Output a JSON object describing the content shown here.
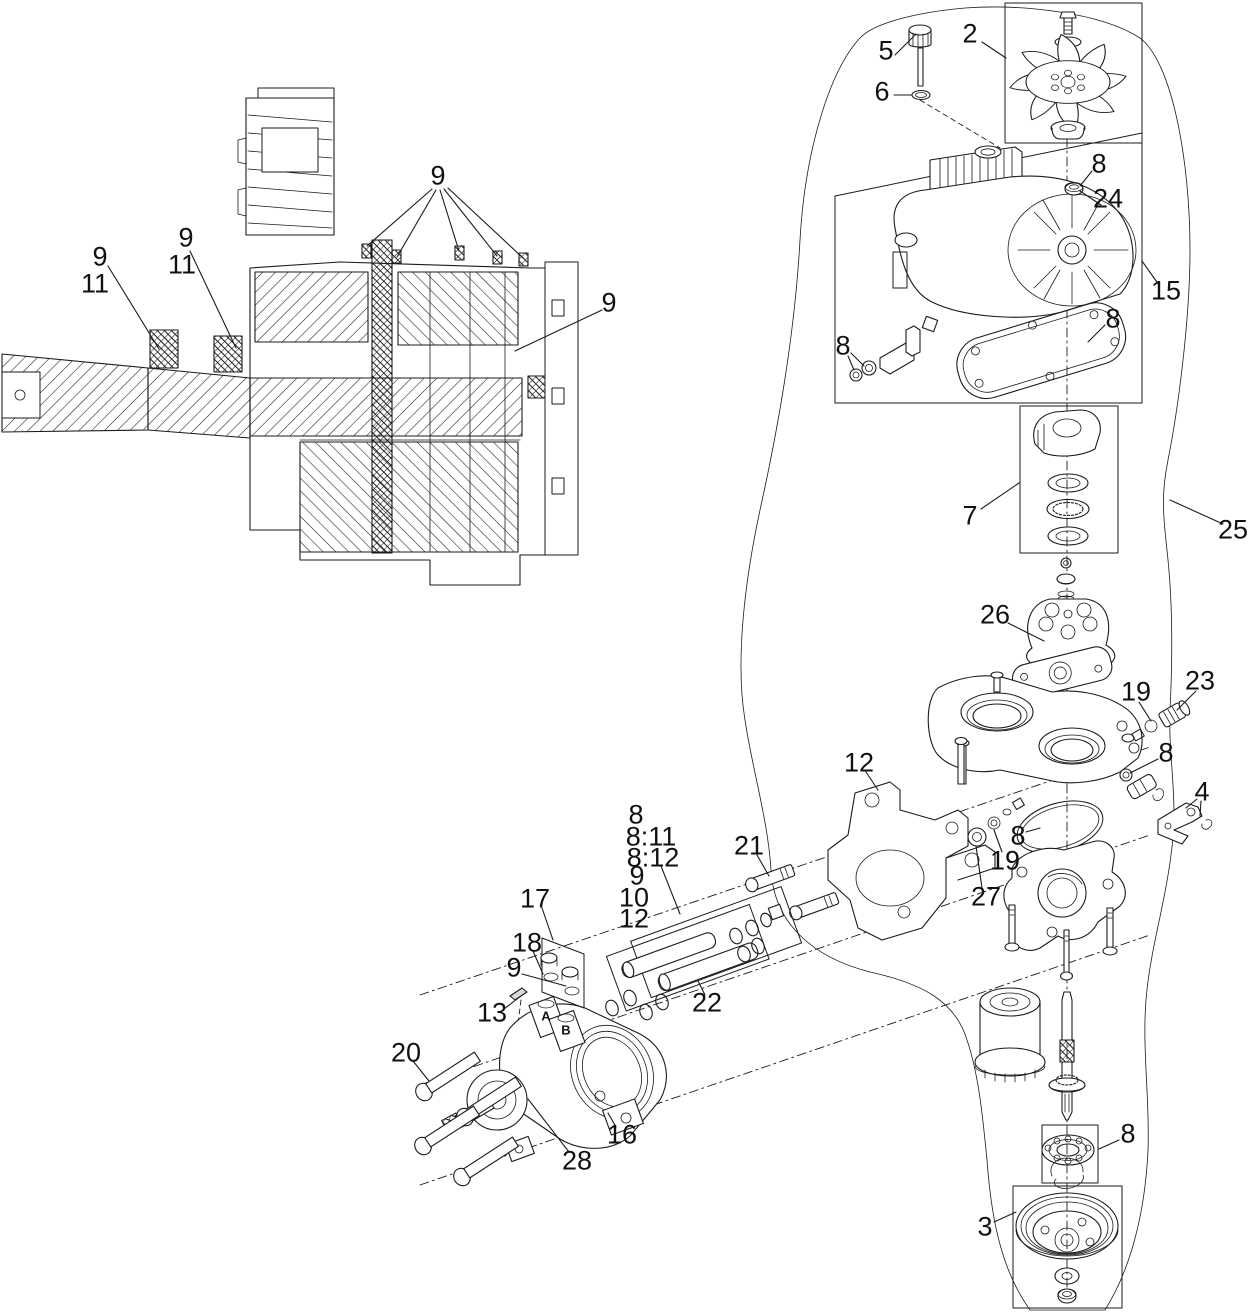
{
  "figure": {
    "background": "#ffffff",
    "line_color": "#1b1b1b"
  },
  "labels": [
    {
      "text": "9",
      "x": 100,
      "y": 257
    },
    {
      "text": "11",
      "x": 95,
      "y": 284
    },
    {
      "text": "9",
      "x": 186,
      "y": 238
    },
    {
      "text": "11",
      "x": 182,
      "y": 265
    },
    {
      "text": "9",
      "x": 438,
      "y": 176
    },
    {
      "text": "9",
      "x": 609,
      "y": 303
    },
    {
      "text": "5",
      "x": 886,
      "y": 51
    },
    {
      "text": "6",
      "x": 882,
      "y": 92
    },
    {
      "text": "2",
      "x": 970,
      "y": 34
    },
    {
      "text": "8",
      "x": 1099,
      "y": 164
    },
    {
      "text": "24",
      "x": 1108,
      "y": 199
    },
    {
      "text": "15",
      "x": 1166,
      "y": 291
    },
    {
      "text": "8",
      "x": 1113,
      "y": 319
    },
    {
      "text": "8",
      "x": 843,
      "y": 346
    },
    {
      "text": "7",
      "x": 970,
      "y": 516
    },
    {
      "text": "25",
      "x": 1233,
      "y": 530
    },
    {
      "text": "26",
      "x": 995,
      "y": 615
    },
    {
      "text": "19",
      "x": 1136,
      "y": 692
    },
    {
      "text": "23",
      "x": 1200,
      "y": 681
    },
    {
      "text": "8",
      "x": 1166,
      "y": 753
    },
    {
      "text": "4",
      "x": 1202,
      "y": 792
    },
    {
      "text": "12",
      "x": 859,
      "y": 763
    },
    {
      "text": "21",
      "x": 749,
      "y": 846
    },
    {
      "text": "8",
      "x": 1018,
      "y": 836
    },
    {
      "text": "19",
      "x": 1005,
      "y": 861
    },
    {
      "text": "27",
      "x": 986,
      "y": 897
    },
    {
      "text": "8",
      "x": 636,
      "y": 815
    },
    {
      "text": "8:11",
      "x": 651,
      "y": 837
    },
    {
      "text": "8:12",
      "x": 653,
      "y": 858
    },
    {
      "text": "9",
      "x": 637,
      "y": 876
    },
    {
      "text": "10",
      "x": 634,
      "y": 898
    },
    {
      "text": "12",
      "x": 634,
      "y": 919
    },
    {
      "text": "17",
      "x": 535,
      "y": 899
    },
    {
      "text": "18",
      "x": 527,
      "y": 943
    },
    {
      "text": "9",
      "x": 514,
      "y": 968
    },
    {
      "text": "13",
      "x": 492,
      "y": 1013
    },
    {
      "text": "22",
      "x": 707,
      "y": 1003
    },
    {
      "text": "20",
      "x": 406,
      "y": 1053
    },
    {
      "text": "16",
      "x": 622,
      "y": 1135
    },
    {
      "text": "28",
      "x": 577,
      "y": 1161
    },
    {
      "text": "8",
      "x": 1128,
      "y": 1134
    },
    {
      "text": "3",
      "x": 985,
      "y": 1227
    },
    {
      "text": "A",
      "x": 546,
      "y": 1016,
      "small": true
    },
    {
      "text": "B",
      "x": 566,
      "y": 1030,
      "small": true
    }
  ]
}
